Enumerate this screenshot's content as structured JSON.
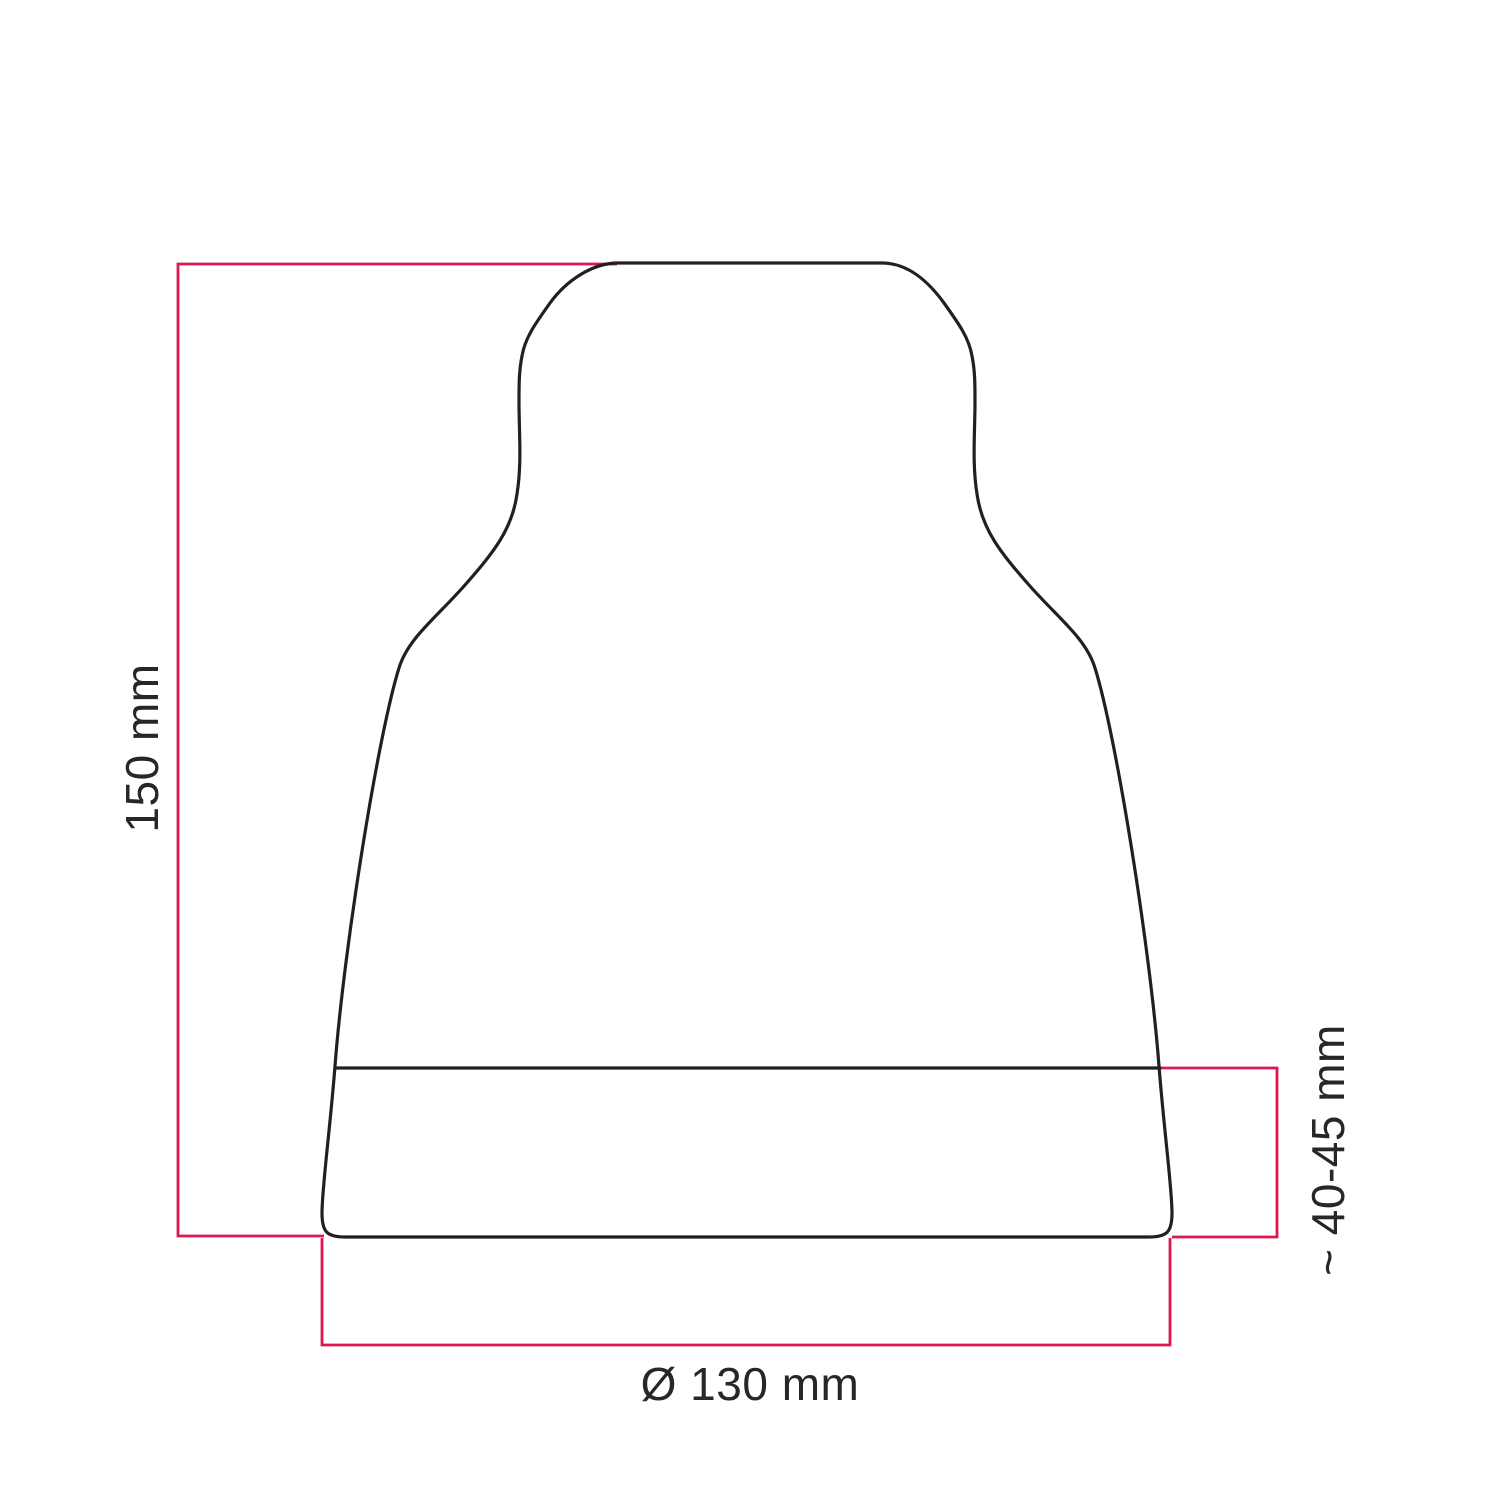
{
  "labels": {
    "height": "150 mm",
    "diameter": "Ø 130 mm",
    "band_height": "~ 40-45 mm"
  },
  "colors": {
    "accent": "#de184e",
    "outline": "#231f20",
    "text": "#2a2627",
    "background": "#ffffff"
  }
}
